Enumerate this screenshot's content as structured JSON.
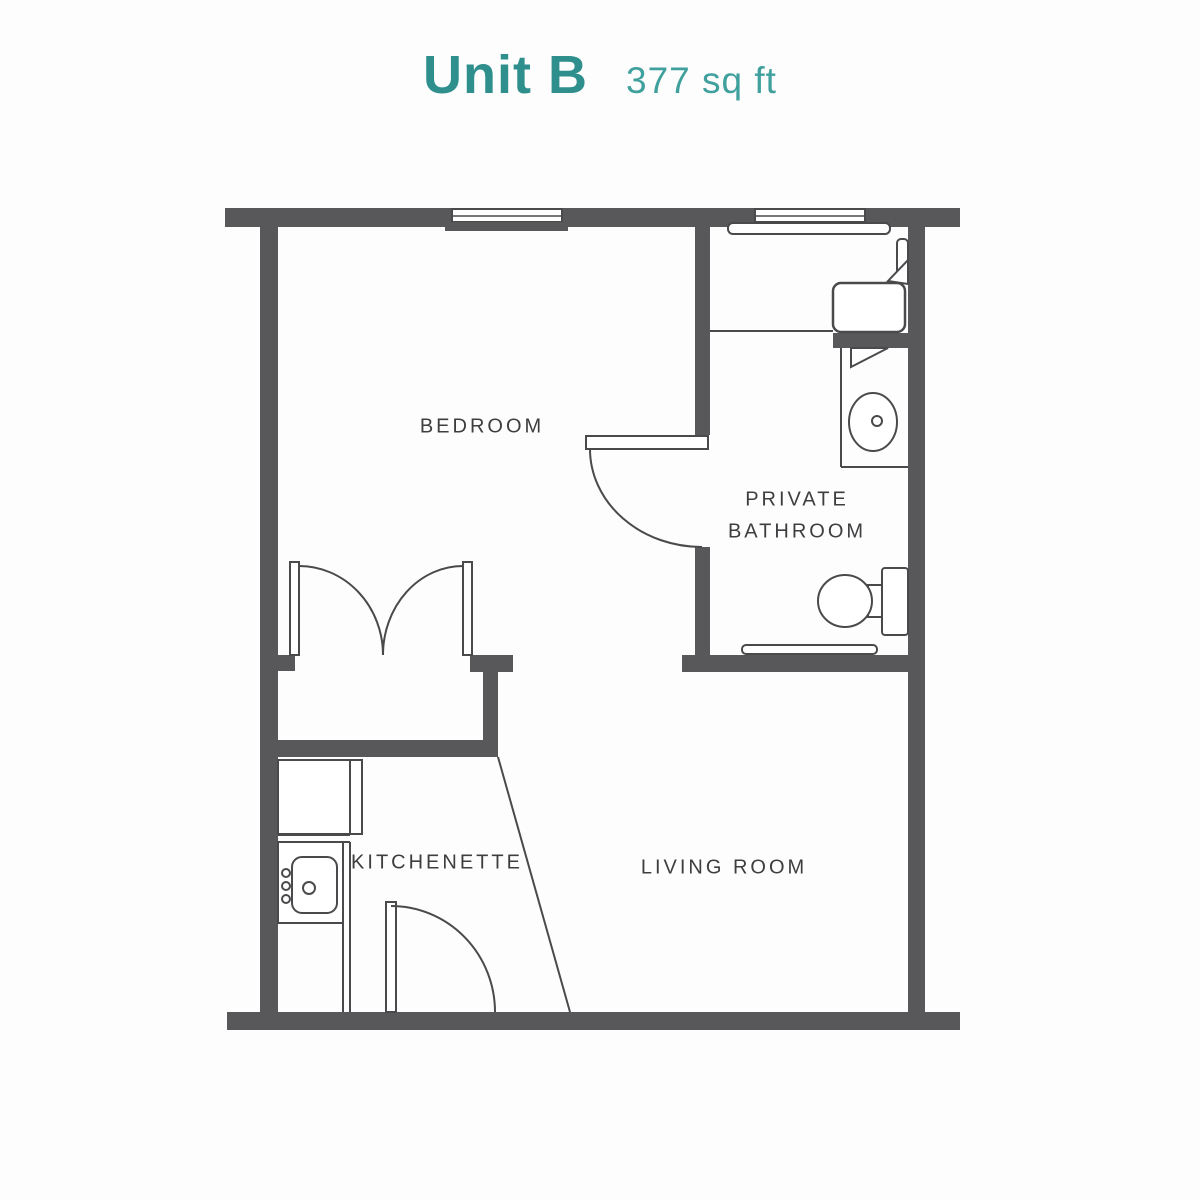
{
  "title": {
    "unit": "Unit B",
    "area": "377 sq ft"
  },
  "rooms": {
    "bedroom": {
      "label": "BEDROOM"
    },
    "bathroom": {
      "label_line1": "PRIVATE",
      "label_line2": "BATHROOM"
    },
    "kitchenette": {
      "label": "KITCHENETTE"
    },
    "living_room": {
      "label": "LIVING ROOM"
    }
  },
  "colors": {
    "unit_title_teal": "#2E8F8D",
    "area_teal": "#3FA09D",
    "wall_gray": "#58585A",
    "line_gray": "#4A4A4C",
    "label_text": "#3E3E40",
    "background": "#FDFDFD"
  },
  "fixtures": [
    "bedroom-window",
    "bathroom-window",
    "closet-double-doors",
    "bathroom-door",
    "entry-door",
    "kitchen-fridge-cabinet",
    "kitchen-sink",
    "kitchen-counter",
    "shower-seat",
    "shower-curtain",
    "bathroom-vanity",
    "bathroom-sink",
    "toilet",
    "bathroom-baseboard"
  ]
}
